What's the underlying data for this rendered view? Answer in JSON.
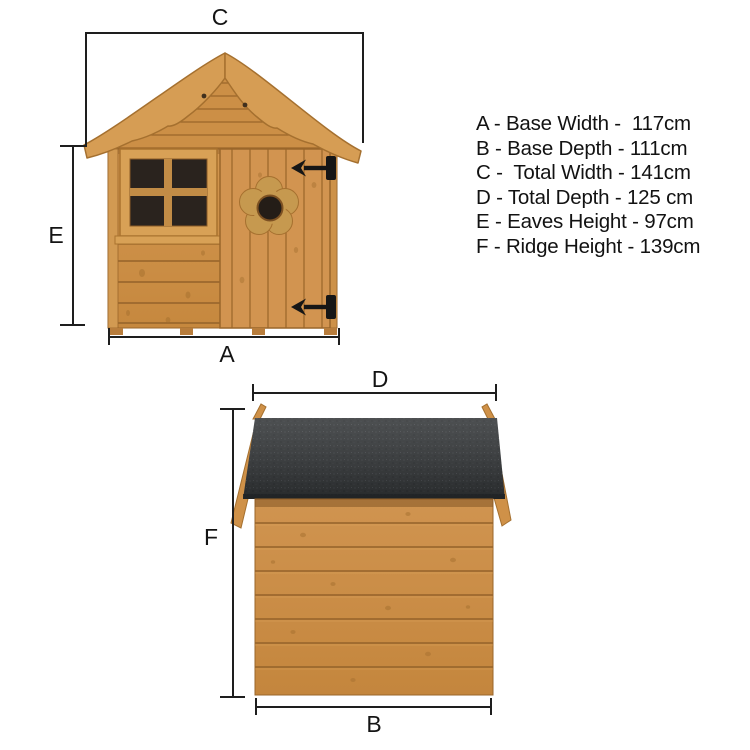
{
  "title": "Playhouse dimensions diagram",
  "legend": {
    "items": [
      "A - Base Width -  117cm",
      "B - Base Depth - 111cm",
      "C -  Total Width - 141cm",
      "D - Total Depth - 125 cm",
      "E - Eaves Height - 97cm",
      "F - Ridge Height - 139cm"
    ]
  },
  "front_view": {
    "top_label": "C",
    "left_label": "E",
    "bottom_label": "A"
  },
  "side_view": {
    "top_label": "D",
    "left_label": "F",
    "bottom_label": "B"
  },
  "colors": {
    "background": "#ffffff",
    "wood": "#cd9148",
    "wood_light": "#d8a156",
    "wood_seam": "#94622a",
    "roof_felt": "#303335",
    "window_pane": "#2a231e",
    "hinge": "#161616",
    "dimension_line": "#1e1e1e",
    "text": "#121212"
  }
}
